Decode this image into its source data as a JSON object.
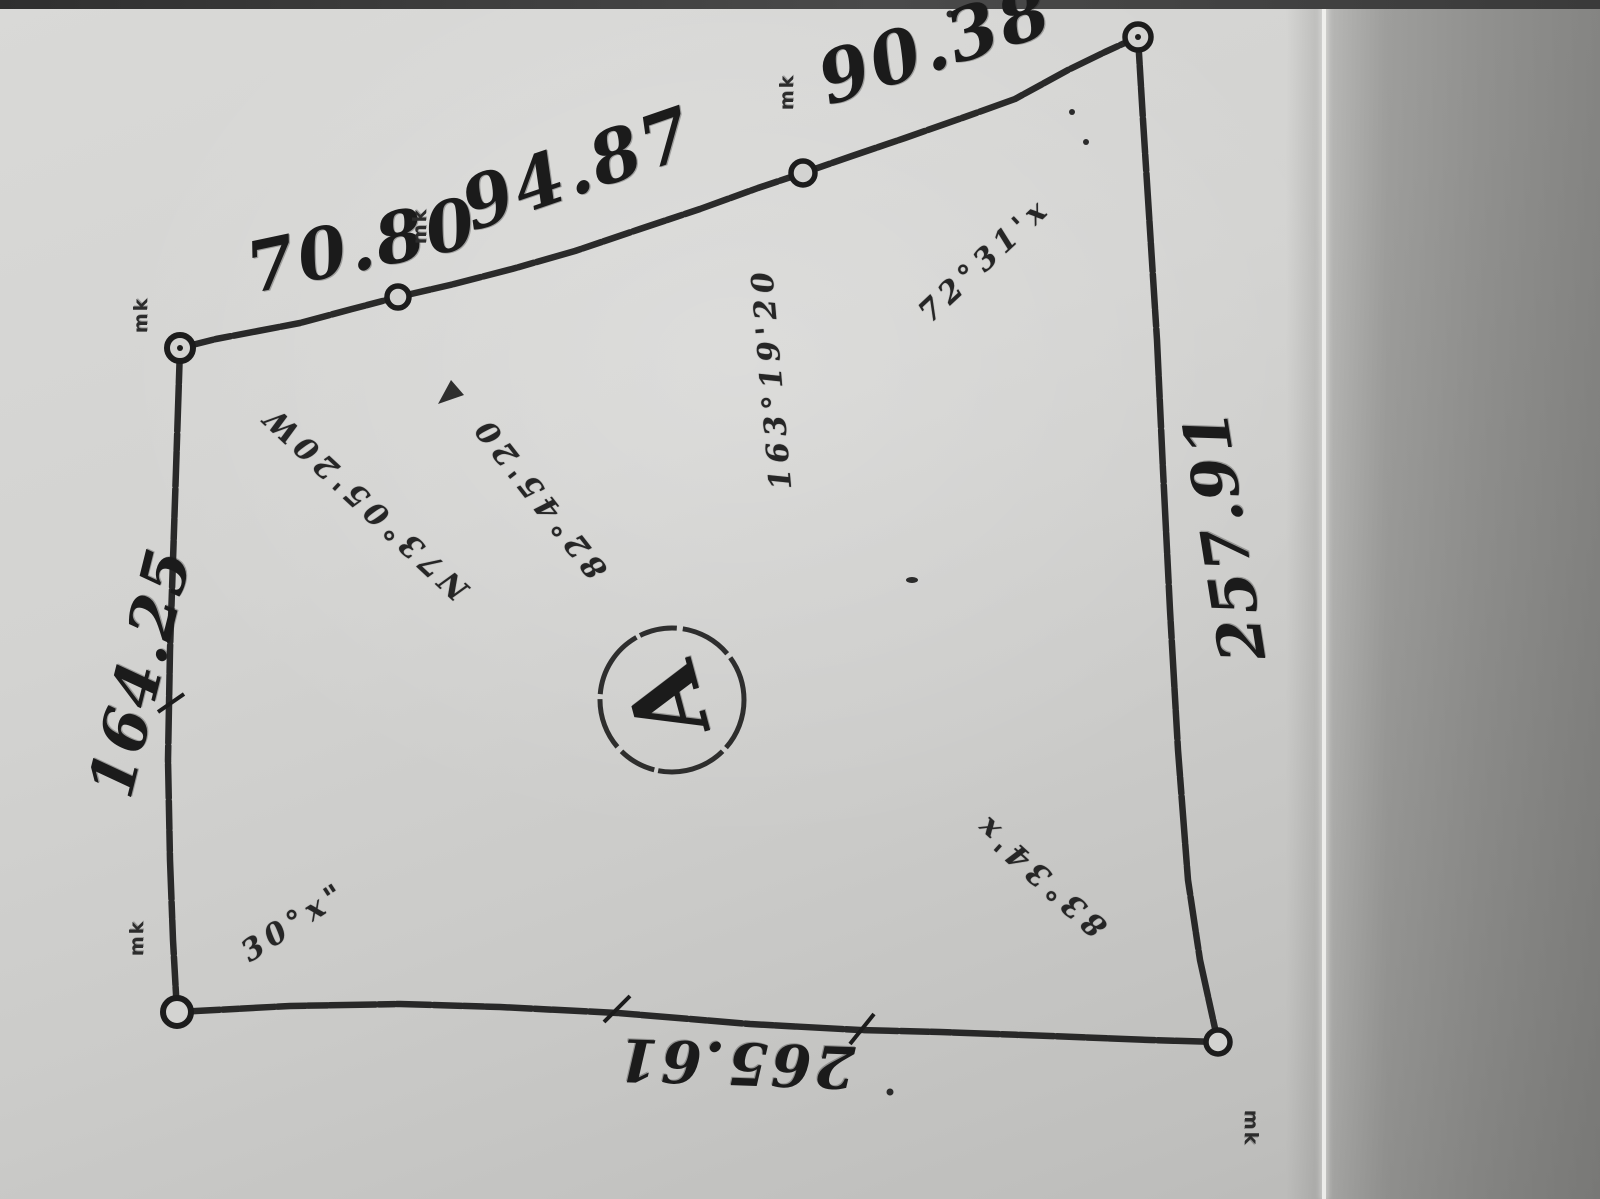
{
  "document": {
    "kind": "Scanned hand-drawn land survey plat (photocopied sketch)",
    "parcel_label": "A"
  },
  "side_lengths": {
    "top_left_segment": "70.80",
    "top_middle_segment": "94.87",
    "top_right_segment": "90.38",
    "right_side": "257.91",
    "left_side": "164.25",
    "bottom_side": "265.61"
  },
  "bearing_annotations": {
    "northwest_diagonal": "N73°05'20W",
    "mid_diagonal": "82°45'20",
    "center_vertical": "163°19'20",
    "northeast_diagonal": "72°31'x",
    "southeast_diagonal": "83°34'x",
    "southwest_corner": "30°x\""
  },
  "corner_marker_note": "mk",
  "colors": {
    "paper": "#d0d0ce",
    "ink": "#1c1c1c",
    "scan_shadow": "#9a9a98",
    "photo_edge": "#3a3a3a"
  }
}
